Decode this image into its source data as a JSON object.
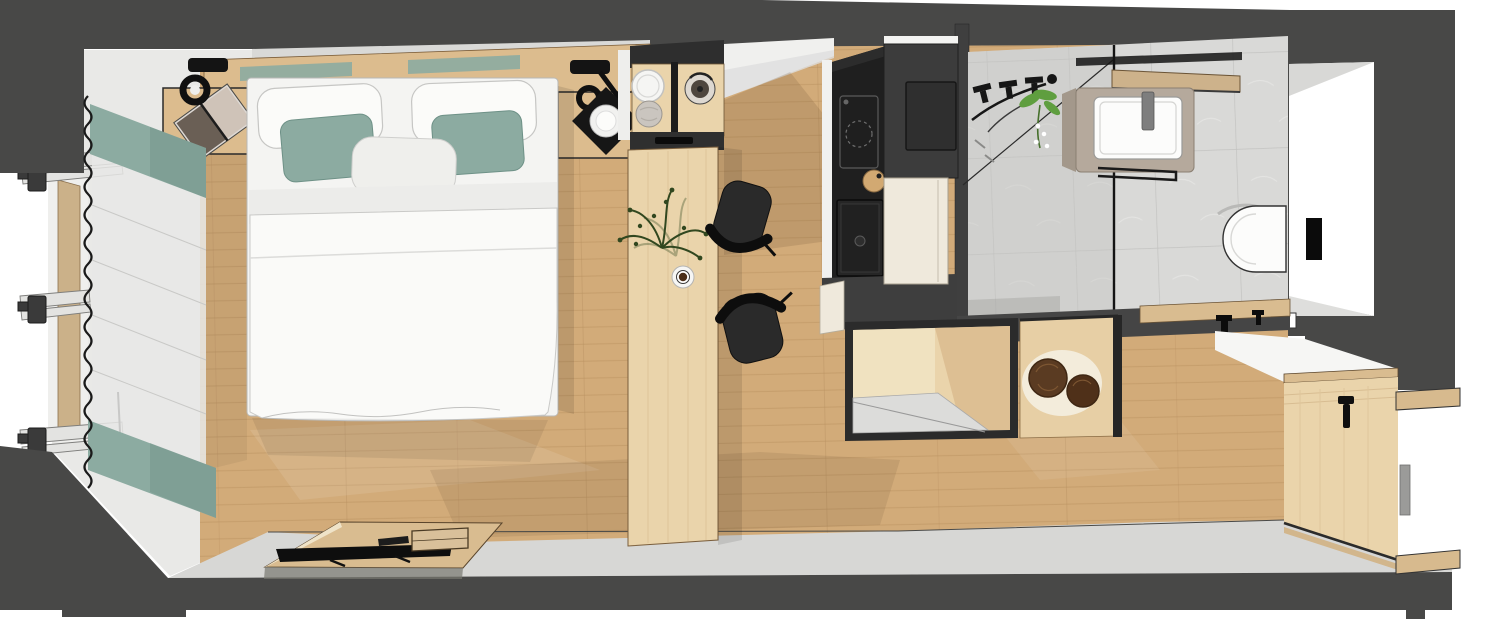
{
  "scene": {
    "type": "floorplan-render",
    "view": "overhead-cutaway",
    "room": "hotel-guestroom-studio"
  },
  "colors": {
    "bg": "#ffffff",
    "wallDark": "#484847",
    "wallLight": "#e9e9e7",
    "wallShadow": "#d9d9d7",
    "floorWood": "#d2ab79",
    "floorWoodLine": "#b78f5e",
    "furnitureWood": "#ead4ab",
    "furnitureWoodDark": "#d9bc90",
    "headboardWood": "#dcbc8e",
    "teal": "#8caba1",
    "tealDeep": "#6e9187",
    "bedWhite": "#f8f8f6",
    "linen": "#efefec",
    "black": "#141414",
    "charcoal": "#2a2a2a",
    "kitchenBlack": "#1f1f1f",
    "wardrobeGray": "#3c3c3c",
    "cream": "#efe9dc",
    "tile": "#d9d9d7",
    "shower": "#c6c6c4",
    "vanityTaupe": "#b5a99c",
    "porcelain": "#fcfcfb",
    "metal": "#7e7e7e",
    "walnut": "#5a3b22",
    "walnutDeep": "#3f2713",
    "entryGray": "#d7d7d5",
    "plantGreen": "#5f9e3f",
    "plantDark": "#31471f",
    "glassLine": "#1a1a1a"
  },
  "zones": {
    "bedroom": [
      "window-curtains",
      "sheer-curtain",
      "curtain-track",
      "double-bed",
      "pillows",
      "accent-cushions",
      "headboard-shelf",
      "nightstand-left",
      "nightstand-right",
      "reading-lamp-left",
      "reading-lamp-right",
      "open-book",
      "decor-tray-plate",
      "tv-sideboard",
      "television",
      "remote-control",
      "storage-tray"
    ],
    "work-dining": [
      "minibar-shelf",
      "plate-stack",
      "bread-basket",
      "kettle",
      "work-table",
      "table-plant",
      "coffee-cup",
      "chair-upper",
      "chair-lower"
    ],
    "kitchenette": [
      "cooktop",
      "kitchen-sink",
      "cutting-board",
      "fridge-door",
      "wardrobe-unit",
      "base-cabinet",
      "luggage-rack",
      "stool-unit",
      "stool-top-large",
      "stool-top-small"
    ],
    "bathroom": [
      "shower-area",
      "shower-fixtures",
      "glass-partition",
      "bathroom-plant",
      "vanity-counter",
      "washbasin",
      "faucet",
      "wood-shelf",
      "towel-rail",
      "toilet",
      "flush-plate"
    ],
    "entry": [
      "door-recess",
      "door-handle",
      "door-hinge",
      "threshold-strip",
      "wall-hooks",
      "entry-desk",
      "desk-hook",
      "wall-shelf-upper",
      "wall-shelf-lower",
      "entry-floor"
    ]
  }
}
